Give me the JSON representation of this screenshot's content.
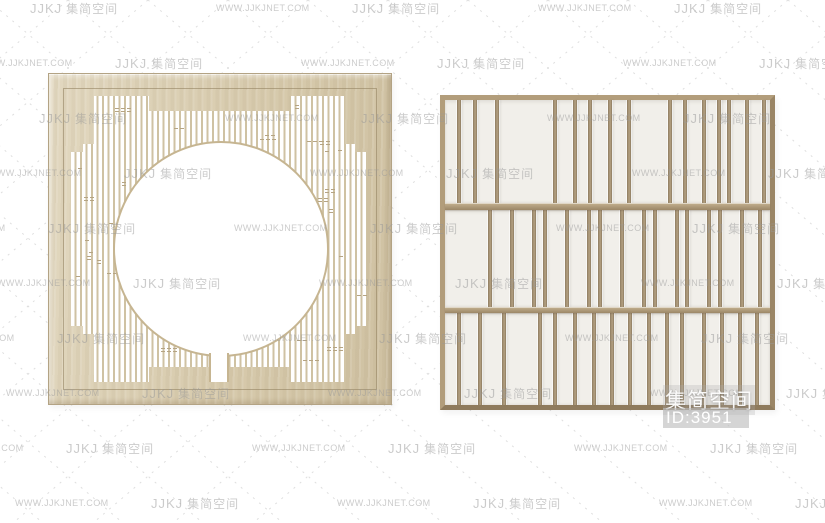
{
  "canvas": {
    "width": 825,
    "height": 523,
    "background": "#ffffff"
  },
  "watermark": {
    "brand_logo": "JJKJ",
    "brand_name": "集简空间",
    "site_url": "WWW.JJKJNET.COM",
    "text_color": "#999999",
    "dash_color": "#d7d7d7",
    "grid": {
      "start_y": 0,
      "row_step": 55,
      "col_step": 161,
      "row_shift": 85,
      "rows": 10,
      "cols": 7,
      "base_x": -131
    }
  },
  "overlay": {
    "brand_text": "集简空间",
    "id_label": "ID:3951",
    "text_color": "#ffffff",
    "badge_bg": "rgba(188,188,188,0.62)"
  },
  "left_panel": {
    "x": 48,
    "y": 73,
    "width": 344,
    "height": 332,
    "wood_light": "#e2d8c0",
    "wood_mid": "#d6c9ab",
    "wood_dark": "#cfc1a2",
    "slat_color": "#cfc2a3",
    "tick_color": "#b5a483",
    "ring_color": "#c6b591",
    "lattice": {
      "x": 20,
      "y": 17,
      "width": 304,
      "height": 292,
      "slat_width": 2,
      "slat_pitch": 5.5,
      "polygon": [
        [
          25,
          5
        ],
        [
          25,
          53
        ],
        [
          14,
          53
        ],
        [
          14,
          61
        ],
        [
          2,
          61
        ],
        [
          2,
          235
        ],
        [
          14,
          235
        ],
        [
          14,
          243
        ],
        [
          25,
          243
        ],
        [
          25,
          291
        ],
        [
          80,
          291
        ],
        [
          80,
          276
        ],
        [
          220,
          276
        ],
        [
          220,
          291
        ],
        [
          275,
          291
        ],
        [
          275,
          243
        ],
        [
          286,
          243
        ],
        [
          286,
          235
        ],
        [
          298,
          235
        ],
        [
          298,
          61
        ],
        [
          286,
          61
        ],
        [
          286,
          53
        ],
        [
          275,
          53
        ],
        [
          275,
          5
        ],
        [
          220,
          5
        ],
        [
          220,
          20
        ],
        [
          80,
          20
        ],
        [
          80,
          5
        ]
      ],
      "columns": [
        [
          2,
          14,
          61,
          235
        ],
        [
          14,
          25,
          53,
          243
        ],
        [
          25,
          80,
          5,
          291
        ],
        [
          80,
          220,
          20,
          276
        ],
        [
          220,
          275,
          5,
          291
        ],
        [
          275,
          286,
          53,
          243
        ],
        [
          286,
          298,
          61,
          235
        ]
      ],
      "circle": {
        "cx": 152,
        "cy": 158,
        "r": 106
      },
      "slot": {
        "x": 140,
        "y": 262,
        "width": 20,
        "height": 29
      },
      "tick_events": 58
    }
  },
  "right_panel": {
    "x": 440,
    "y": 95,
    "width": 335,
    "height": 315,
    "frame_top": "#b29d7b",
    "frame_left": "#b29d7b",
    "frame_right": "#9a8565",
    "frame_bottom": "#8f7b5d",
    "panel_bg": "#f1efea",
    "slat_dark": "#8d7b60",
    "slat_light": "#b4a182",
    "slat_width": 4,
    "rail_light": "#c4b190",
    "rail_dark": "#9c8767",
    "rails": [
      {
        "top": 103,
        "height": 7
      },
      {
        "top": 207,
        "height": 6
      }
    ],
    "bands": [
      {
        "top": 0,
        "height": 103,
        "slats": [
          12,
          28,
          50,
          108,
          128,
          143,
          163,
          182,
          223,
          238,
          257,
          272,
          282,
          300,
          317
        ]
      },
      {
        "top": 110,
        "height": 97,
        "slats": [
          43,
          65,
          87,
          98,
          120,
          142,
          153,
          175,
          197,
          208,
          230,
          240,
          262,
          273,
          295,
          313
        ]
      },
      {
        "top": 213,
        "height": 92,
        "slats": [
          12,
          33,
          57,
          93,
          108,
          128,
          147,
          165,
          183,
          202,
          220,
          235,
          257,
          275,
          293,
          310
        ]
      }
    ]
  }
}
